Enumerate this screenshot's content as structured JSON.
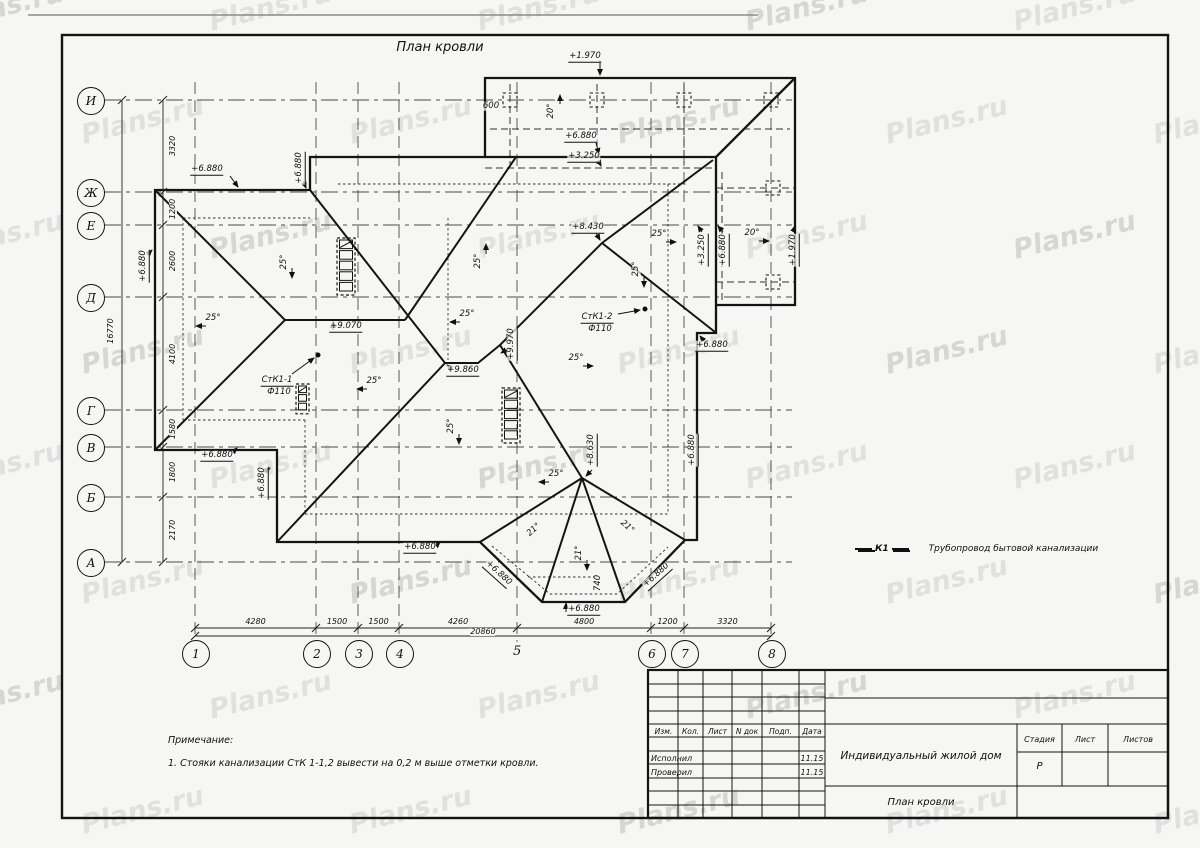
{
  "sheet": {
    "title": "План кровли",
    "watermark": "Plans.ru"
  },
  "axes": {
    "rows": [
      {
        "label": "И",
        "y": 100
      },
      {
        "label": "Ж",
        "y": 192
      },
      {
        "label": "Е",
        "y": 225
      },
      {
        "label": "Д",
        "y": 297
      },
      {
        "label": "Г",
        "y": 410
      },
      {
        "label": "В",
        "y": 447
      },
      {
        "label": "Б",
        "y": 497
      },
      {
        "label": "А",
        "y": 562
      }
    ],
    "cols": [
      {
        "label": "1",
        "x": 195,
        "circled": true
      },
      {
        "label": "2",
        "x": 316,
        "circled": true
      },
      {
        "label": "3",
        "x": 358,
        "circled": true
      },
      {
        "label": "4",
        "x": 399,
        "circled": true
      },
      {
        "label": "5",
        "x": 517,
        "circled": false
      },
      {
        "label": "6",
        "x": 651,
        "circled": true
      },
      {
        "label": "7",
        "x": 684,
        "circled": true
      },
      {
        "label": "8",
        "x": 771,
        "circled": true
      }
    ],
    "row_segments": [
      "3320",
      "1200",
      "2600",
      "4100",
      "1580",
      "1800",
      "2170"
    ],
    "row_total": "16770",
    "col_segments": [
      "4280",
      "1500",
      "1500",
      "4260",
      "4800",
      "1200",
      "3320"
    ],
    "col_total": "20860"
  },
  "roof_labels": [
    {
      "text": "+1.970",
      "x": 585,
      "y": 57,
      "rot": 0,
      "ul": true
    },
    {
      "text": "600",
      "x": 491,
      "y": 106,
      "rot": 0,
      "ul": false
    },
    {
      "text": "20°",
      "x": 551,
      "y": 111,
      "rot": -90,
      "ul": false
    },
    {
      "text": "+6.880",
      "x": 581,
      "y": 137,
      "rot": 0,
      "ul": true
    },
    {
      "text": "+3.250",
      "x": 584,
      "y": 157,
      "rot": 0,
      "ul": true
    },
    {
      "text": "+6.880",
      "x": 207,
      "y": 170,
      "rot": 0,
      "ul": true
    },
    {
      "text": "+6.880",
      "x": 300,
      "y": 168,
      "rot": -90,
      "ul": true
    },
    {
      "text": "+6.880",
      "x": 144,
      "y": 266,
      "rot": -90,
      "ul": true
    },
    {
      "text": "25°",
      "x": 213,
      "y": 318,
      "rot": 0,
      "ul": false
    },
    {
      "text": "25°",
      "x": 284,
      "y": 262,
      "rot": -90,
      "ul": false
    },
    {
      "text": "25°",
      "x": 478,
      "y": 261,
      "rot": -90,
      "ul": false
    },
    {
      "text": "+9.070",
      "x": 346,
      "y": 327,
      "rot": 0,
      "ul": true
    },
    {
      "text": "СтК1-1",
      "x": 277,
      "y": 381,
      "rot": 0,
      "ul": true
    },
    {
      "text": "Ф110",
      "x": 279,
      "y": 392,
      "rot": 0,
      "ul": false
    },
    {
      "text": "25°",
      "x": 374,
      "y": 381,
      "rot": 0,
      "ul": false
    },
    {
      "text": "25°",
      "x": 451,
      "y": 426,
      "rot": -90,
      "ul": false
    },
    {
      "text": "+9.860",
      "x": 463,
      "y": 371,
      "rot": 0,
      "ul": true
    },
    {
      "text": "+9.970",
      "x": 512,
      "y": 344,
      "rot": -90,
      "ul": true
    },
    {
      "text": "25°",
      "x": 467,
      "y": 314,
      "rot": 0,
      "ul": false
    },
    {
      "text": "25°",
      "x": 576,
      "y": 358,
      "rot": 0,
      "ul": false
    },
    {
      "text": "СтК1-2",
      "x": 597,
      "y": 318,
      "rot": 0,
      "ul": true
    },
    {
      "text": "Ф110",
      "x": 600,
      "y": 329,
      "rot": 0,
      "ul": false
    },
    {
      "text": "+8.430",
      "x": 588,
      "y": 228,
      "rot": 0,
      "ul": true
    },
    {
      "text": "25°",
      "x": 659,
      "y": 234,
      "rot": 0,
      "ul": false
    },
    {
      "text": "25°",
      "x": 636,
      "y": 269,
      "rot": -90,
      "ul": false
    },
    {
      "text": "20°",
      "x": 752,
      "y": 233,
      "rot": 0,
      "ul": false
    },
    {
      "text": "+3.250",
      "x": 703,
      "y": 250,
      "rot": -90,
      "ul": true
    },
    {
      "text": "+6.880",
      "x": 724,
      "y": 250,
      "rot": -90,
      "ul": true
    },
    {
      "text": "+1.970",
      "x": 794,
      "y": 250,
      "rot": -90,
      "ul": true
    },
    {
      "text": "+6.880",
      "x": 712,
      "y": 346,
      "rot": 0,
      "ul": true
    },
    {
      "text": "+6.880",
      "x": 693,
      "y": 450,
      "rot": -90,
      "ul": true
    },
    {
      "text": "+8.630",
      "x": 592,
      "y": 450,
      "rot": -90,
      "ul": true
    },
    {
      "text": "25°",
      "x": 556,
      "y": 474,
      "rot": 0,
      "ul": false
    },
    {
      "text": "21°",
      "x": 534,
      "y": 530,
      "rot": -42,
      "ul": false
    },
    {
      "text": "21°",
      "x": 579,
      "y": 553,
      "rot": -90,
      "ul": false
    },
    {
      "text": "21°",
      "x": 627,
      "y": 527,
      "rot": 42,
      "ul": false
    },
    {
      "text": "740",
      "x": 598,
      "y": 583,
      "rot": -90,
      "ul": false
    },
    {
      "text": "+6.880",
      "x": 498,
      "y": 574,
      "rot": 42,
      "ul": true
    },
    {
      "text": "+6.880",
      "x": 584,
      "y": 610,
      "rot": 0,
      "ul": true
    },
    {
      "text": "+6.880",
      "x": 657,
      "y": 576,
      "rot": -42,
      "ul": true
    },
    {
      "text": "+6.880",
      "x": 217,
      "y": 456,
      "rot": 0,
      "ul": true
    },
    {
      "text": "+6.880",
      "x": 263,
      "y": 483,
      "rot": -90,
      "ul": true
    },
    {
      "text": "+6.880",
      "x": 420,
      "y": 548,
      "rot": 0,
      "ul": true
    }
  ],
  "legend": {
    "code": "К1",
    "text": "Трубопровод бытовой канализации"
  },
  "notes": {
    "heading": "Примечание:",
    "item": "1. Стояки канализации СтК 1-1,2 вывести на 0,2 м выше отметки кровли."
  },
  "titleblock": {
    "columns": [
      "Изм.",
      "Кол.",
      "Лист",
      "N док",
      "Подп.",
      "Дата"
    ],
    "rows": [
      {
        "role": "Исполнил",
        "date": "11.15"
      },
      {
        "role": "Проверил",
        "date": "11.15"
      }
    ],
    "project": "Индивидуальный жилой дом",
    "drawing_title": "План кровли",
    "stage_columns": [
      "Стадия",
      "Лист",
      "Листов"
    ],
    "stage": "Р"
  }
}
